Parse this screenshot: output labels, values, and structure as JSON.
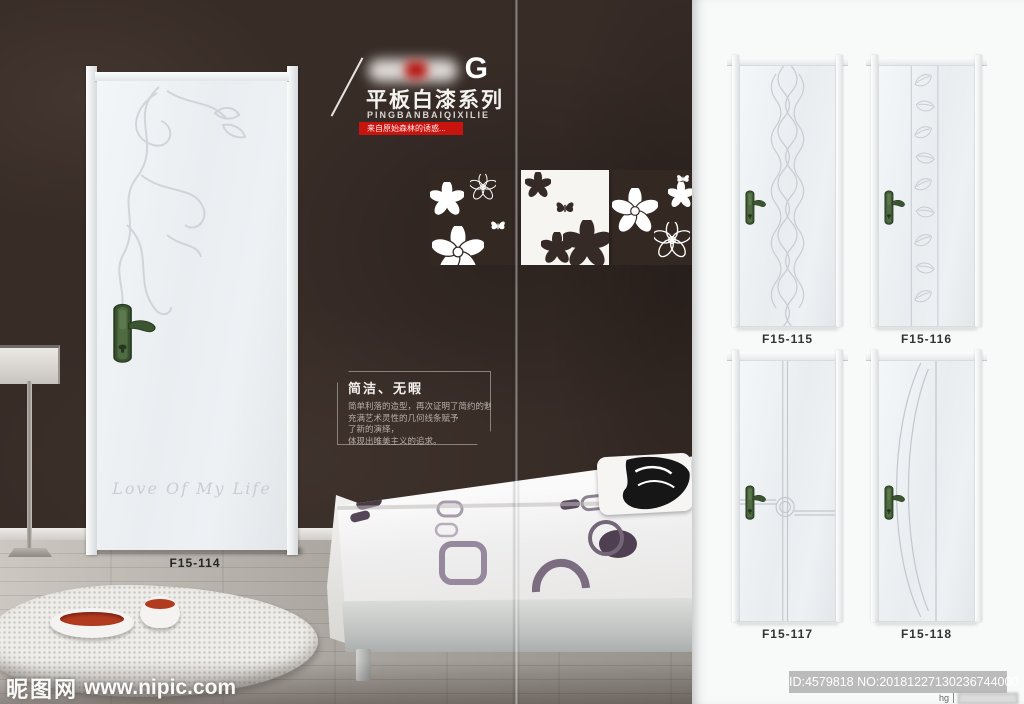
{
  "brand": {
    "logo_letter": "G",
    "series_title": "平板白漆系列",
    "series_subtitle": "PINGBANBAIQIXILIE",
    "tagline": "来自原始森林的诱惑..."
  },
  "feature": {
    "title": "简洁、无暇",
    "lines": [
      "简单利落的造型，再次证明了简约的魅力。",
      "充满艺术灵性的几何线条赋予",
      "了新的演绎，",
      "体现出唯美主义的追求。"
    ]
  },
  "showcase": {
    "door_model": "F15-114",
    "door_script": "Love Of My Life"
  },
  "catalog": {
    "doors": [
      {
        "model": "F15-115",
        "pattern": "vertical-waves"
      },
      {
        "model": "F15-116",
        "pattern": "leaf-column"
      },
      {
        "model": "F15-117",
        "pattern": "cross-lines-loop"
      },
      {
        "model": "F15-118",
        "pattern": "sweeping-arcs"
      }
    ]
  },
  "watermark": {
    "site_name": "昵图网",
    "site_url": "www.nipic.com",
    "image_id": "ID:4579818 NO:20181227130236744000",
    "corner_text": "hg"
  },
  "colors": {
    "accent_red": "#c8140e",
    "handle_green": "#44603c",
    "wall_brown": "#382c27",
    "floor_gray": "#a8a29c",
    "panel_bg": "#f8f9f9"
  }
}
